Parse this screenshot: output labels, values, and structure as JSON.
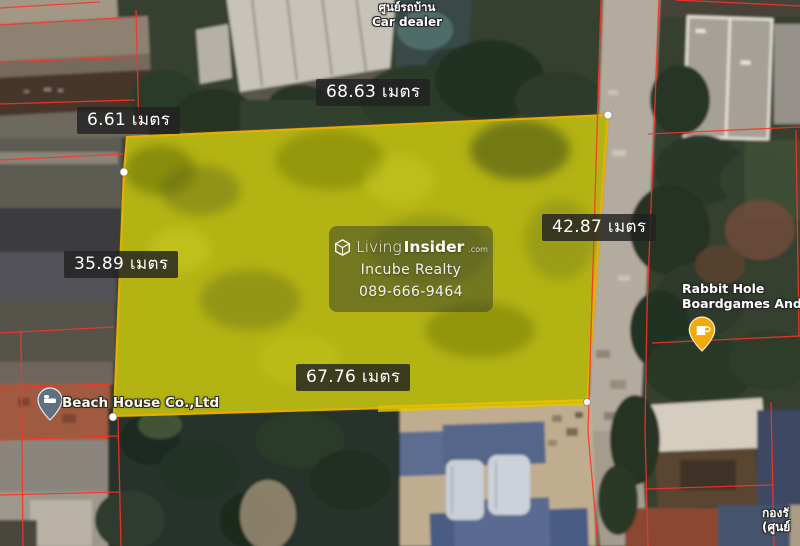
{
  "map_overlay": {
    "dimensions": {
      "top": "68.63 เมตร",
      "top_left": "6.61 เมตร",
      "left": "35.89 เมตร",
      "right": "42.87 เมตร",
      "bottom": "67.76 เมตร"
    },
    "watermark": {
      "brand_first": "Living",
      "brand_second": "Insider",
      "brand_suffix": ".com",
      "agency": "Incube Realty",
      "phone": "089-666-9464"
    },
    "pois": {
      "car_dealer": {
        "line1": "ศูนย์รถบ้าน",
        "line2": "Car dealer"
      },
      "beach_house": {
        "label": "Beach House Co.,Ltd"
      },
      "rabbit_hole": {
        "line1": "Rabbit Hole",
        "line2": "Boardgames And C"
      },
      "bottom_right_thai": {
        "line1": "กองรั",
        "line2": "(ศูนย์"
      }
    },
    "colors": {
      "plot_fill": "#e8e000",
      "plot_stroke": "#edaf00",
      "parcel_line": "#ff3126",
      "dimension_label_background": "#212121",
      "rabbit_pin": "#f2a90a",
      "beach_pin": "#5f7082"
    }
  }
}
